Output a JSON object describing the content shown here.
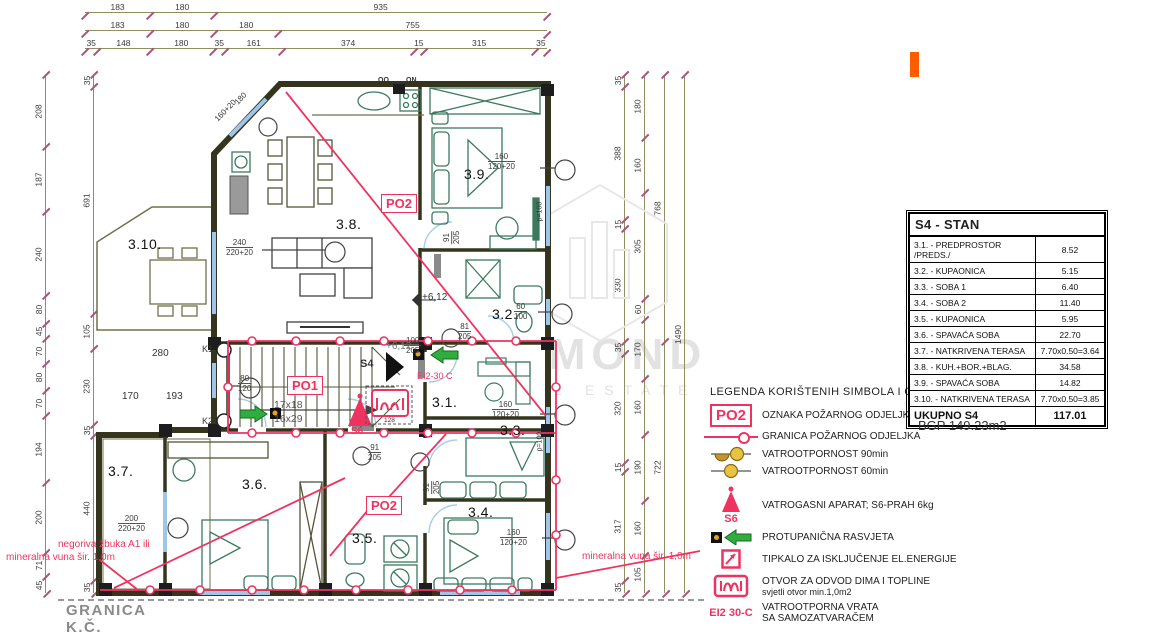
{
  "dims": {
    "top": [
      [
        "183",
        "180",
        "935"
      ],
      [
        "183",
        "180",
        "180",
        "755"
      ],
      [
        "35",
        "148",
        "180",
        "35",
        "161",
        "374",
        "15",
        "315",
        "35"
      ]
    ],
    "left": [
      [
        "208",
        "187",
        "240",
        "80",
        "45",
        "70",
        "80",
        "70",
        "194",
        "200",
        "71",
        "45"
      ],
      [
        "35",
        "691",
        "105",
        "230",
        "35",
        "440",
        "35"
      ]
    ],
    "right": [
      [
        "35",
        "388",
        "15",
        "330",
        "35",
        "320",
        "15",
        "317",
        "35"
      ],
      [
        "180",
        "160",
        "305",
        "60",
        "170",
        "160",
        "190",
        "160",
        "105"
      ],
      [
        "768",
        "722"
      ],
      [
        "1490"
      ]
    ]
  },
  "plan": {
    "rooms": {
      "r1": "3.1.",
      "r2": "3.2.",
      "r3": "3.3.",
      "r4": "3.4.",
      "r5": "3.5.",
      "r6": "3.6.",
      "r7": "3.7.",
      "r8": "3.8.",
      "r9": "3.9.",
      "r10": "3.10."
    },
    "windows": {
      "w240": {
        "top": "240",
        "bot": "220+20"
      },
      "w200": {
        "top": "200",
        "bot": "220+20"
      },
      "w160a": {
        "top": "160",
        "bot": "120+20"
      },
      "w60": {
        "top": "60",
        "bot": "100"
      },
      "w160b": {
        "top": "160",
        "bot": "120+20"
      },
      "w160c": {
        "top": "160",
        "bot": "120+20"
      },
      "d81": {
        "top": "81",
        "bot": "205"
      },
      "d91a": {
        "top": "91",
        "bot": "205"
      },
      "d91b": {
        "top": "91",
        "bot": "205"
      },
      "d91c": {
        "top": "91",
        "bot": "205"
      },
      "d100": {
        "top": "100",
        "bot": "205"
      },
      "k80": {
        "top": "80",
        "bot": "120"
      }
    },
    "texts": {
      "oo": "OO",
      "on": "ON",
      "k1": "K1",
      "k2": "K2",
      "d280": "280",
      "d193": "193",
      "d170": "170",
      "lvl1": "+6,12",
      "lvl2": "+6,12",
      "st1": "17x18",
      "st2": "16x29",
      "s4": "S4",
      "s6": "S6",
      "po1": "PO1",
      "po2a": "PO2",
      "po2b": "PO2",
      "ei_plan": "EI2-30 C",
      "n128": "128",
      "p100a": "p=100",
      "p100b": "p=100",
      "t180": "180",
      "t16020": "160+20",
      "granica_kc": "GRANICA K.Č.",
      "negoriva1": "negoriva žbuka A1 ili",
      "negoriva2": "mineralna vuna šir. 1,0m",
      "mineralna_r": "mineralna vuna šir. 1,0m"
    }
  },
  "legend": {
    "title": "LEGENDA KORIŠTENIH SIMBOLA  I OZNAKA",
    "items": [
      {
        "sym_label": "PO2",
        "text": "OZNAKA POŽARNOG ODJELJKA"
      },
      {
        "text": "GRANICA POŽARNOG ODJELJKA"
      },
      {
        "text": "VATROOTPORNOST 90min"
      },
      {
        "text": "VATROOTPORNOST 60min"
      },
      {
        "sym_label": "S6",
        "text": "VATROGASNI APARAT; S6-PRAH 6kg"
      },
      {
        "text": "PROTUPANIČNA RASVJETA"
      },
      {
        "text": "TIPKALO ZA ISKLJUČENJE EL.ENERGIJE"
      },
      {
        "text": "OTVOR ZA ODVOD DIMA I TOPLINE",
        "sub": "svjetli otvor min.1,0m2"
      },
      {
        "sym_label": "EI2 30-C",
        "text": "VATROOTPORNA VRATA",
        "sub": "SA SAMOZATVARAČEM"
      }
    ]
  },
  "table": {
    "title": "S4 - STAN",
    "rows": [
      {
        "label": "3.1. - PREDPROSTOR /PREDS./",
        "value": "8.52"
      },
      {
        "label": "3.2. - KUPAONICA",
        "value": "5.15"
      },
      {
        "label": "3.3. - SOBA 1",
        "value": "6.40"
      },
      {
        "label": "3.4. - SOBA 2",
        "value": "11.40"
      },
      {
        "label": "3.5. - KUPAONICA",
        "value": "5.95"
      },
      {
        "label": "3.6. - SPAVAĆA SOBA",
        "value": "22.70"
      },
      {
        "label": "3.7. - NATKRIVENA TERASA",
        "value": "7.70x0.50=3.64"
      },
      {
        "label": "3.8. - KUH.+BOR.+BLAG.",
        "value": "34.58"
      },
      {
        "label": "3.9. - SPAVAĆA SOBA",
        "value": "14.82"
      },
      {
        "label": "3.10. - NATKRIVENA TERASA",
        "value": "7.70x0.50=3.85"
      }
    ],
    "total": {
      "label": "UKUPNO S4",
      "value": "117.01"
    }
  },
  "misc": {
    "bgp": "BGP 149.23m2"
  },
  "watermark": {
    "word": "DIAMOND",
    "sub": "REAL ESTATE"
  }
}
